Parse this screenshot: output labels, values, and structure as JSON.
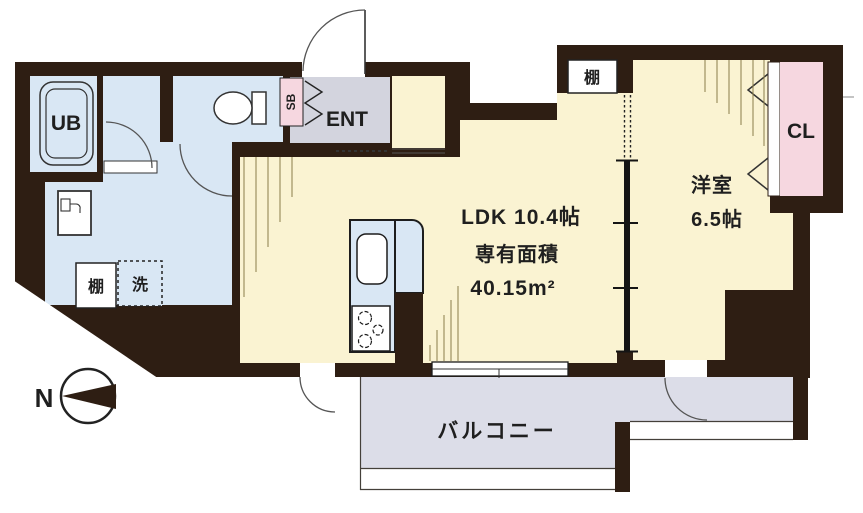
{
  "title": "apartment floor plan",
  "labels": {
    "ub": "UB",
    "ent": "ENT",
    "shoe_box": "SB",
    "shelf_top": "棚",
    "shelf_wash": "棚",
    "washer": "洗",
    "ldk_size": "LDK 10.4帖",
    "area_label": "専有面積",
    "area_value": "40.15m²",
    "western_room": "洋室",
    "western_room_size": "6.5帖",
    "closet": "CL",
    "balcony": "バルコニー",
    "compass_north": "N"
  },
  "colors": {
    "wall": "#2e1e13",
    "room_cream": "#faf3d2",
    "wet_area_blue": "#d9e7f4",
    "entrance_gray": "#d3d4de",
    "balcony_gray": "#dcdde8",
    "closet_pink": "#f6d7e0",
    "hatch_olive": "#8b7d4a"
  }
}
